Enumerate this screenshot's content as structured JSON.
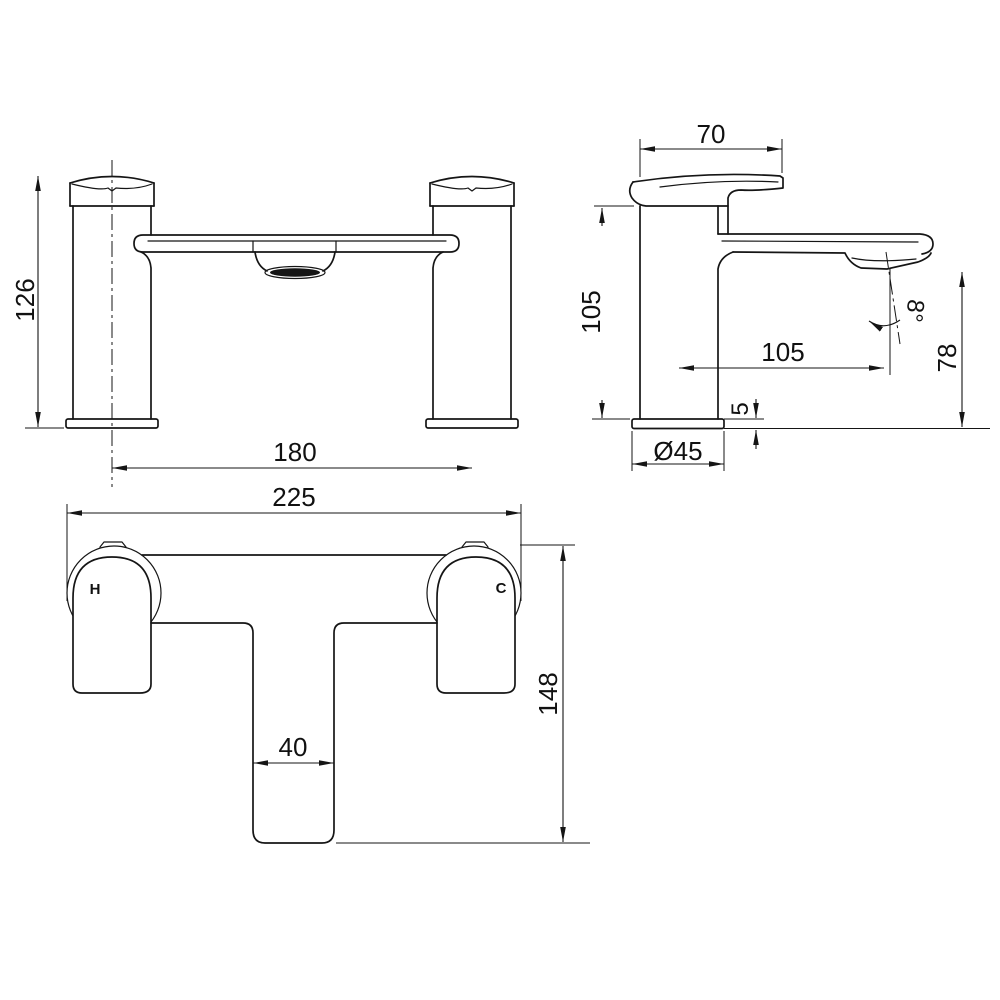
{
  "drawing": {
    "front_view": {
      "height": "126",
      "spacing": "180"
    },
    "side_view": {
      "handle_length": "70",
      "body_height": "105",
      "spout_reach": "105",
      "spray_angle": "8°",
      "outlet_height": "78",
      "deck_thickness": "5",
      "base_diameter": "Ø45"
    },
    "plan_view": {
      "overall_width": "225",
      "overall_depth": "148",
      "spout_width": "40",
      "hot_label": "H",
      "cold_label": "C"
    }
  }
}
